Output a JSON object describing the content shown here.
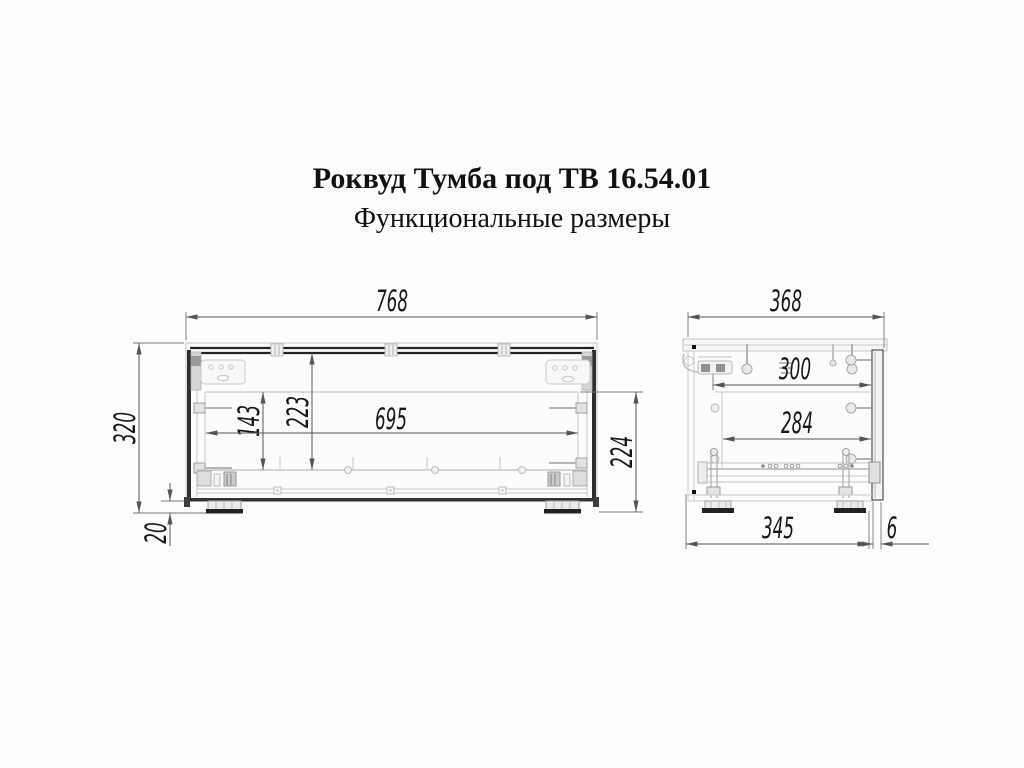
{
  "header": {
    "title": "Роквуд Тумба под ТВ 16.54.01",
    "subtitle": "Функциональные размеры"
  },
  "front_view": {
    "dims": {
      "overall_width": "768",
      "overall_height": "320",
      "plinth_height": "20",
      "inner_height_left": "143",
      "inner_height_center": "223",
      "inner_width": "695",
      "opening_height": "224"
    }
  },
  "side_view": {
    "dims": {
      "overall_depth": "368",
      "top_inner_depth": "300",
      "inner_depth": "284",
      "base_depth": "345",
      "door_gap": "6"
    }
  },
  "colors": {
    "background": "#fdfdfd",
    "drawing_light_line": "#c9c9c9",
    "drawing_dark_line": "#222222",
    "dimension_line": "#555555",
    "dimension_text": "#161616",
    "title_text": "#111111"
  }
}
